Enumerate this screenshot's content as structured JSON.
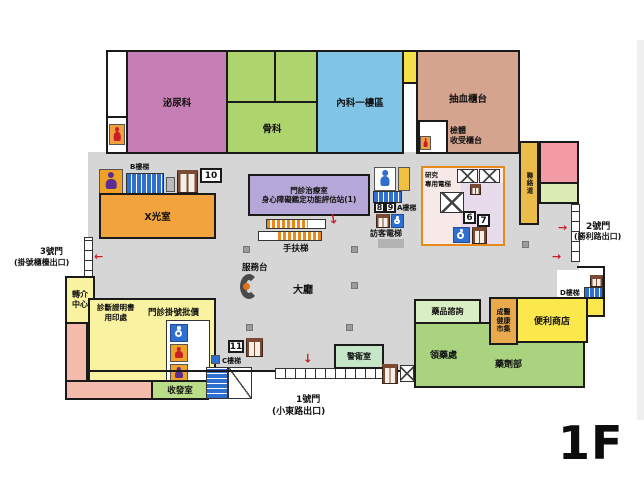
{
  "floor_label": "1F",
  "gates": {
    "gate1_name": "1號門",
    "gate1_exit": "(小東路出口)",
    "gate2_name": "2號門",
    "gate2_exit": "(勝利路出口)",
    "gate3_name": "3號門",
    "gate3_exit": "(掛號櫃檯出口)"
  },
  "rooms": {
    "urology": "泌尿科",
    "orthopedics": "骨科",
    "internal_medicine": "內科一樓區",
    "blood_draw": "抽血櫃台",
    "specimen_line1": "檢體",
    "specimen_line2": "收受櫃台",
    "xray": "X光室",
    "clinic_line1": "門診治療室",
    "clinic_line2": "身心障礙鑑定功能評估站(1)",
    "guard": "警衛室",
    "mailroom": "收發室",
    "drug_consult": "藥品諮詢",
    "medication_pickup": "領藥處",
    "pharmacy": "藥劑部",
    "market_line1": "成醫",
    "market_line2": "健康",
    "market_line3": "市集",
    "store": "便利商店",
    "link_corridor": "聯絡道"
  },
  "hall": {
    "service_desk": "服務台",
    "lobby": "大廳",
    "escalator": "手扶梯",
    "referral_line1": "轉介",
    "referral_line2": "中心",
    "cert_line1": "診斷證明書",
    "cert_line2": "用印處",
    "registration": "門診掛號批價"
  },
  "stairs": {
    "a": "A樓梯",
    "b": "B樓梯",
    "c": "C樓梯",
    "d": "D樓梯"
  },
  "elevators": {
    "research_line1": "研究",
    "research_line2": "專用電梯",
    "visitor": "訪客電梯"
  },
  "numbers": {
    "n6": "6",
    "n7": "7",
    "n8": "8",
    "n9": "9",
    "n10": "10",
    "n11": "11"
  },
  "colors": {
    "corridor": "#d6d6d6",
    "urology": "#c57fb4",
    "green_room": "#aed46e",
    "internal": "#80c4e6",
    "blood": "#d5a48f",
    "xray": "#f2a33e",
    "clinic": "#b5a7d7",
    "yellow_zone": "#f9f2a0",
    "pink_zone": "#f4bbac",
    "guard": "#c6e6c8",
    "pharmacy_green": "#a9d37f",
    "store_yellow": "#fbe84c",
    "market_orange": "#e9aa4e",
    "link_gold": "#ecbc4a",
    "accent_red": "#c8202a"
  }
}
